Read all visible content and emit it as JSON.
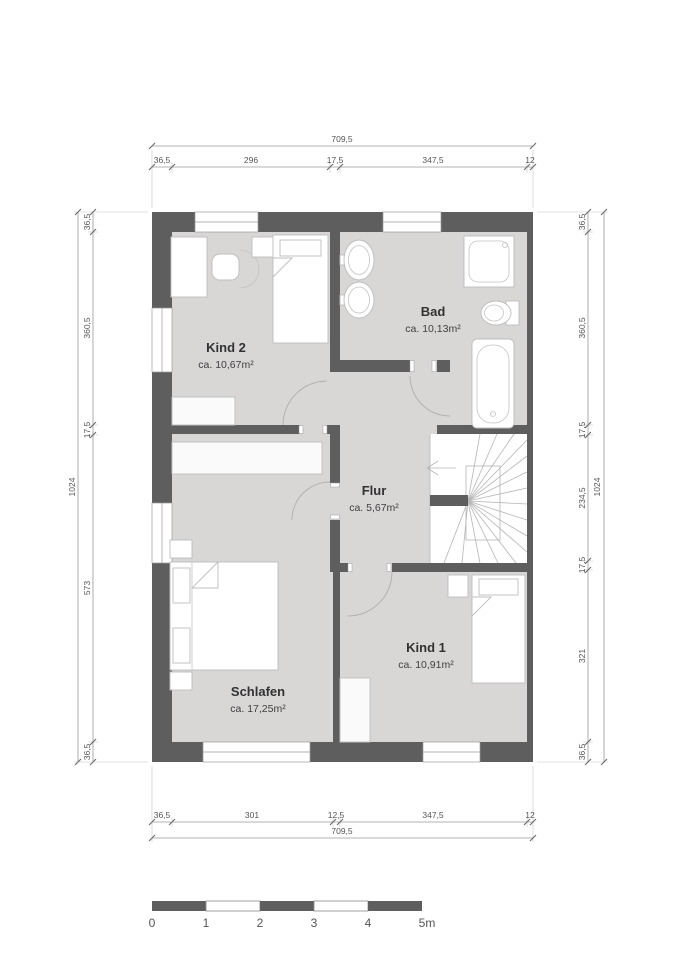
{
  "rooms": {
    "kind2": {
      "name": "Kind 2",
      "area": "ca. 10,67m²"
    },
    "bad": {
      "name": "Bad",
      "area": "ca. 10,13m²"
    },
    "flur": {
      "name": "Flur",
      "area": "ca. 5,67m²"
    },
    "schlafen": {
      "name": "Schlafen",
      "area": "ca. 17,25m²"
    },
    "kind1": {
      "name": "Kind 1",
      "area": "ca. 10,91m²"
    }
  },
  "dimensions": {
    "top": {
      "total": "709,5",
      "segments": [
        "36,5",
        "296",
        "17,5",
        "347,5",
        "12"
      ]
    },
    "bottom": {
      "total": "709,5",
      "segments": [
        "36,5",
        "301",
        "12,5",
        "347,5",
        "12"
      ]
    },
    "left": {
      "total": "1024",
      "segments": [
        "36,5",
        "360,5",
        "17,5",
        "573",
        "36,5"
      ]
    },
    "right": {
      "total": "1024",
      "segments": [
        "36,5",
        "360,5",
        "17,5",
        "234,5",
        "17,5",
        "321",
        "36,5"
      ]
    }
  },
  "scale_bar": {
    "labels": [
      "0",
      "1",
      "2",
      "3",
      "4",
      "5m"
    ]
  },
  "colors": {
    "wall": "#5e5e5e",
    "floor": "#d9d6d6"
  }
}
